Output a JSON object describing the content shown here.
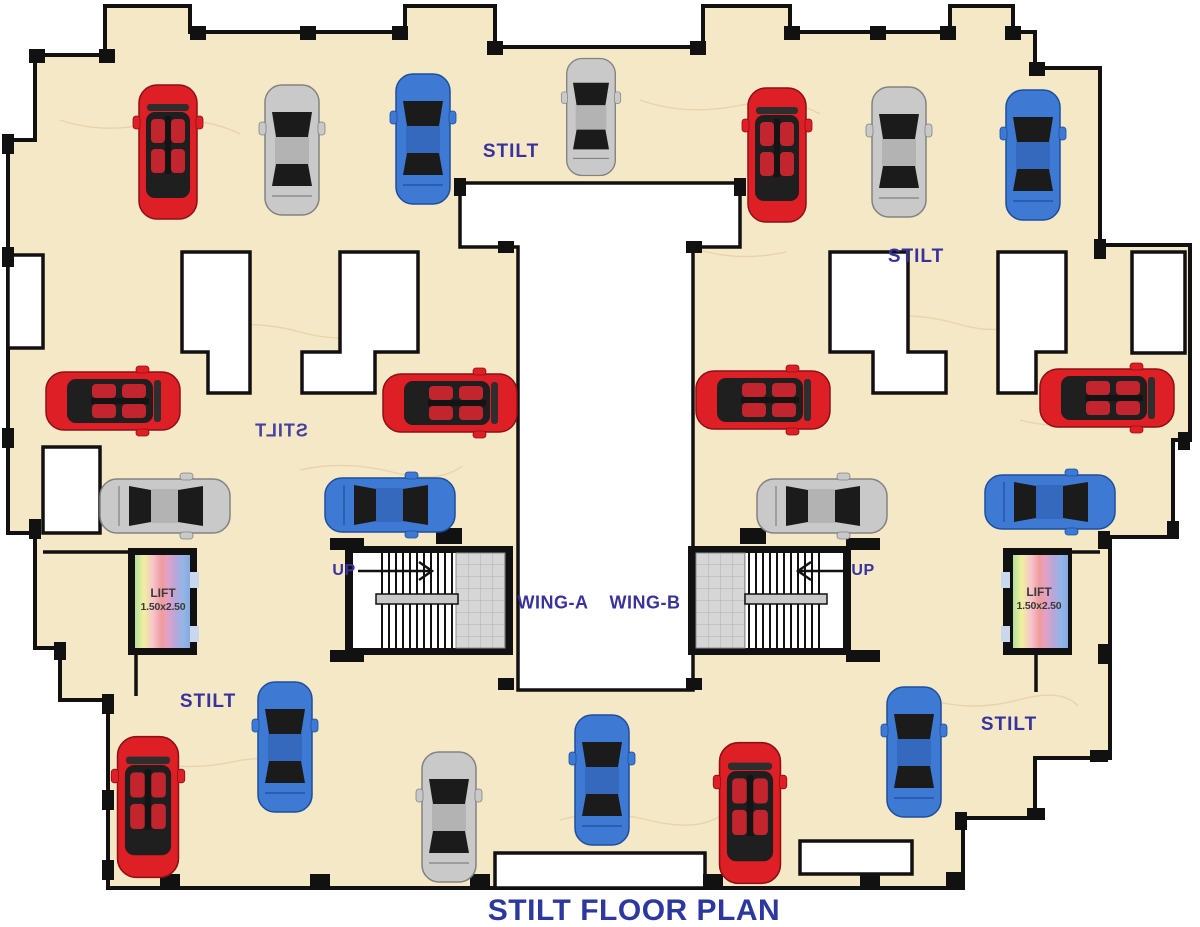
{
  "title": "STILT FLOOR PLAN",
  "labels": {
    "stilt_top_left": "STILT",
    "stilt_top_right": "STILT",
    "stilt_mirrored": "STILT",
    "stilt_bottom_left": "STILT",
    "stilt_bottom_right": "STILT",
    "up_left": "UP",
    "up_right": "UP",
    "wing_a": "WING-A",
    "wing_b": "WING-B"
  },
  "lifts": {
    "left": {
      "line1": "LIFT",
      "line2": "1.50x2.50"
    },
    "right": {
      "line1": "LIFT",
      "line2": "1.50x2.50"
    }
  },
  "colors": {
    "floor": "#f4e8c7",
    "wall": "#111111",
    "label_blue": "#38329e",
    "title_blue": "#2c379f",
    "car_red": "#df1f26",
    "car_silver": "#c9c9c9",
    "car_blue": "#3e7ad4",
    "stair_landing": "#d6d6d6",
    "lift_rainbow": [
      "#b6e09e",
      "#eff09e",
      "#f7c1ce",
      "#f09b9b",
      "#e2a1c6",
      "#b7a6da",
      "#93b6e7",
      "#86a9e2"
    ]
  },
  "cars": [
    {
      "type": "convertible",
      "color": "red",
      "x": 168,
      "y": 152,
      "rot": 0,
      "scale": 1
    },
    {
      "type": "sedan",
      "color": "silver",
      "x": 292,
      "y": 150,
      "rot": 0,
      "scale": 1
    },
    {
      "type": "sedan",
      "color": "blue",
      "x": 423,
      "y": 139,
      "rot": 0,
      "scale": 1
    },
    {
      "type": "sedan",
      "color": "silver",
      "x": 591,
      "y": 117,
      "rot": 0,
      "scale": 0.9
    },
    {
      "type": "convertible",
      "color": "red",
      "x": 777,
      "y": 155,
      "rot": 0,
      "scale": 1
    },
    {
      "type": "sedan",
      "color": "silver",
      "x": 899,
      "y": 152,
      "rot": 0,
      "scale": 1
    },
    {
      "type": "sedan",
      "color": "blue",
      "x": 1033,
      "y": 155,
      "rot": 0,
      "scale": 1
    },
    {
      "type": "convertible",
      "color": "red",
      "x": 113,
      "y": 401,
      "rot": 90,
      "scale": 1
    },
    {
      "type": "convertible",
      "color": "red",
      "x": 450,
      "y": 403,
      "rot": 90,
      "scale": 1
    },
    {
      "type": "convertible",
      "color": "red",
      "x": 763,
      "y": 400,
      "rot": 90,
      "scale": 1
    },
    {
      "type": "convertible",
      "color": "red",
      "x": 1107,
      "y": 398,
      "rot": 90,
      "scale": 1
    },
    {
      "type": "sedan",
      "color": "silver",
      "x": 165,
      "y": 506,
      "rot": 90,
      "scale": 1
    },
    {
      "type": "sedan",
      "color": "blue",
      "x": 390,
      "y": 505,
      "rot": 90,
      "scale": 1
    },
    {
      "type": "sedan",
      "color": "silver",
      "x": 822,
      "y": 506,
      "rot": 90,
      "scale": 1
    },
    {
      "type": "sedan",
      "color": "blue",
      "x": 1050,
      "y": 502,
      "rot": 90,
      "scale": 1
    },
    {
      "type": "convertible",
      "color": "red",
      "x": 148,
      "y": 807,
      "rot": 0,
      "scale": 1.05
    },
    {
      "type": "sedan",
      "color": "blue",
      "x": 285,
      "y": 747,
      "rot": 0,
      "scale": 1
    },
    {
      "type": "sedan",
      "color": "silver",
      "x": 449,
      "y": 817,
      "rot": 0,
      "scale": 1
    },
    {
      "type": "sedan",
      "color": "blue",
      "x": 602,
      "y": 780,
      "rot": 0,
      "scale": 1
    },
    {
      "type": "convertible",
      "color": "red",
      "x": 750,
      "y": 813,
      "rot": 0,
      "scale": 1.05
    },
    {
      "type": "sedan",
      "color": "blue",
      "x": 914,
      "y": 752,
      "rot": 0,
      "scale": 1
    }
  ]
}
